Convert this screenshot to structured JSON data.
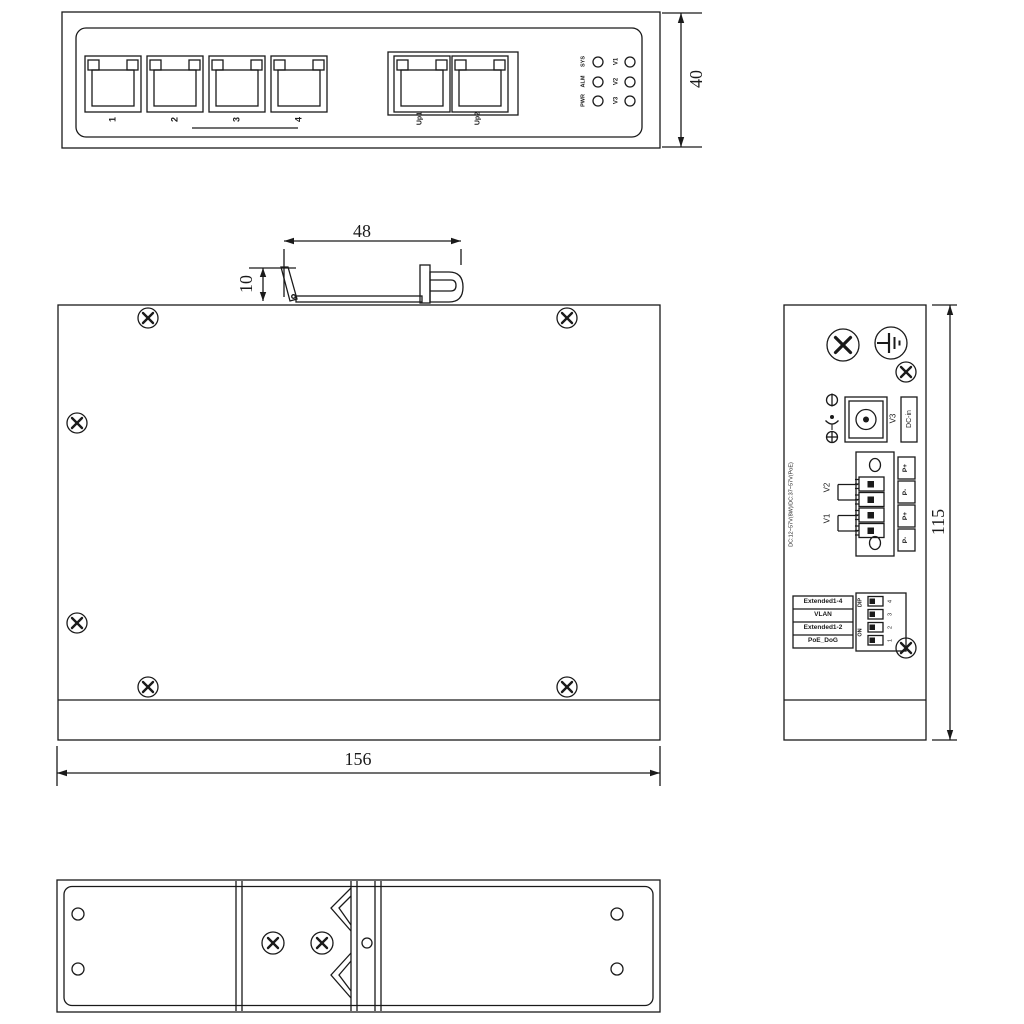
{
  "front_view": {
    "port_labels": [
      "1",
      "2",
      "3",
      "4"
    ],
    "uplink_labels": [
      "Up1",
      "Up2"
    ],
    "led_left": [
      "SYS",
      "ALM",
      "PWR"
    ],
    "led_right": [
      "V1",
      "V2",
      "V3"
    ],
    "dim_height": "40"
  },
  "top_view": {
    "dim_din_width": "48",
    "dim_din_height": "10",
    "dim_width": "156"
  },
  "side_view": {
    "v3_label": "V3",
    "dc_in_label": "DC-in",
    "terminal_v2": "V2",
    "terminal_v1": "V1",
    "pins": [
      "P+",
      "P-",
      "P+",
      "P-"
    ],
    "spec": "DC:12~57V(8W)/DC:37~57V(PoE)",
    "dip_rows": [
      "Extended1-4",
      "VLAN",
      "Extended1-2",
      "PoE_DoG"
    ],
    "dip_label": "DIP",
    "on_label": "ON",
    "dip_numbers": [
      "4",
      "3",
      "2",
      "1"
    ],
    "dim_height": "115"
  }
}
